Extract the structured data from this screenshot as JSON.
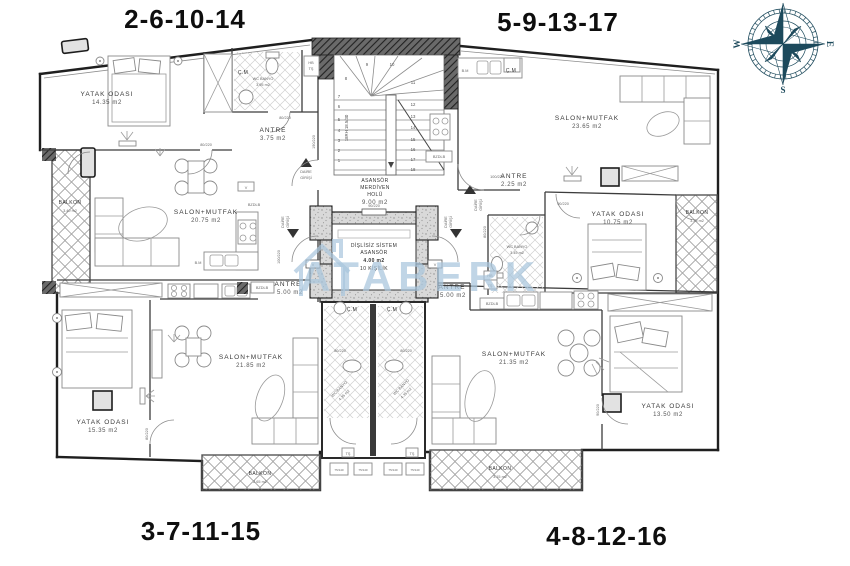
{
  "page": {
    "background": "#ffffff"
  },
  "titles": {
    "top_left": "2-6-10-14",
    "top_right": "5-9-13-17",
    "bottom_left": "3-7-11-15",
    "bottom_right": "4-8-12-16"
  },
  "compass": {
    "w": "W",
    "e": "E",
    "s": "S",
    "color": "#1d4a5c"
  },
  "watermark": {
    "text": "ATABERK",
    "color": "#a9c6dd"
  },
  "core": {
    "hall": {
      "l1": "ASANSÖR",
      "l2": "MERDİVEN",
      "l3": "HOLÜ",
      "area": "9.00 m2"
    },
    "elevator": {
      "l1": "DİŞLİSİZ SİSTEM",
      "l2": "ASANSÖR",
      "area": "4.00 m2",
      "capacity": "10 KİŞİLİK"
    },
    "stair_spec": "18RH 18.5/30",
    "stair_numbers": [
      "1",
      "2",
      "3",
      "4",
      "5",
      "6",
      "7",
      "8",
      "9",
      "10",
      "11",
      "12",
      "13",
      "14",
      "15",
      "16",
      "17",
      "18"
    ],
    "entrance_l1": "DAİRE",
    "entrance_l2": "GİRİŞİ",
    "vent": "V"
  },
  "apartments": {
    "top_left": {
      "bedroom": {
        "name": "YATAK ODASI",
        "area": "14.35 m2"
      },
      "salon": {
        "name": "SALON+MUTFAK",
        "area": "20.75 m2"
      },
      "antre": {
        "name": "ANTRE",
        "area": "3.75 m2"
      },
      "bath": {
        "name": "WC BANYO",
        "area": "3.95 m2"
      },
      "balcony": {
        "name": "BALKON",
        "area": "3.40 m2"
      },
      "cm": "Ç.M",
      "bm": "B.M",
      "hb1": "HB",
      "hb2": "TŞ",
      "bzdlb": "BZDLB"
    },
    "top_right": {
      "salon": {
        "name": "SALON+MUTFAK",
        "area": "23.65 m2"
      },
      "antre": {
        "name": "ANTRE",
        "area": "2.25 m2"
      },
      "bedroom": {
        "name": "YATAK ODASI",
        "area": "10.75 m2"
      },
      "bath": {
        "name": "WC BANYO",
        "area": "3.45 m2"
      },
      "balcony": {
        "name": "BALKON",
        "area": "3.35 m2"
      },
      "cm": "Ç.M",
      "bm": "B.M",
      "bzdlb": "BZDLB"
    },
    "bottom_left": {
      "antre": {
        "name": "ANTRE",
        "area": "5.00 m2"
      },
      "salon": {
        "name": "SALON+MUTFAK",
        "area": "21.85 m2"
      },
      "bedroom": {
        "name": "YATAK ODASI",
        "area": "15.35 m2"
      },
      "balcony": {
        "name": "BALKON",
        "area": "2.65 m2"
      },
      "bzdlb": "BZDLB"
    },
    "bottom_right": {
      "antre": {
        "name": "ANTRE",
        "area": "5.00 m2"
      },
      "salon": {
        "name": "SALON+MUTFAK",
        "area": "21.35 m2"
      },
      "bedroom": {
        "name": "YATAK ODASI",
        "area": "13.50 m2"
      },
      "balcony": {
        "name": "BALKON",
        "area": "3.15 m2"
      },
      "hb1": "HB",
      "hb2": "TŞ",
      "bzdlb": "BZDLB"
    }
  },
  "shared_baths": {
    "left": {
      "cm": "Ç.M",
      "name": "WC BANYO",
      "area": "4.35 m2",
      "ts": "TŞ"
    },
    "right": {
      "cm": "Ç.M",
      "name": "WC BANYO",
      "area": "4.35 m2",
      "ts": "TŞ"
    }
  },
  "door_labels": {
    "d80": "80/220",
    "d90": "90/220",
    "d100": "100/220",
    "d190": "190/220",
    "d75": "75/140"
  }
}
